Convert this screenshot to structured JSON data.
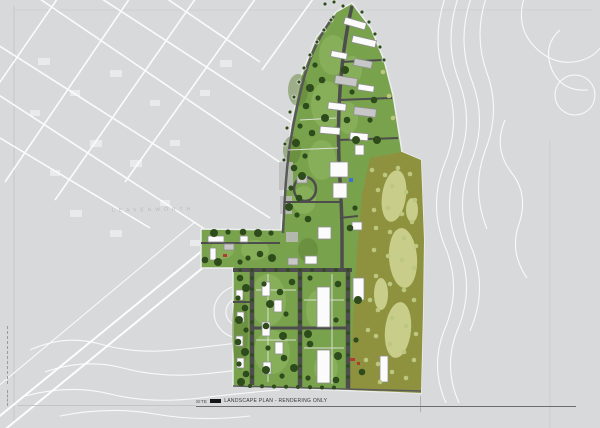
{
  "drawing": {
    "title_caption": {
      "keynote": "SITE",
      "label": "LANDSCAPE PLAN - RENDERING ONLY"
    },
    "basemap": {
      "street_label": "LEAVENWORTH"
    },
    "colors": {
      "sheet_background": "#d8d9db",
      "survey_linework": "#ffffff",
      "site_green": "#79a24c",
      "lawn_green": "#7fb052",
      "tree_green": "#2e4b1b",
      "golf_olive": "#8e923f",
      "fairway_pale": "#ccd18d",
      "road_gray": "#4d4d4d",
      "building_white": "#fbfbfb",
      "accent_red": "#b23a2e",
      "accent_blue": "#3f6fd0"
    }
  }
}
